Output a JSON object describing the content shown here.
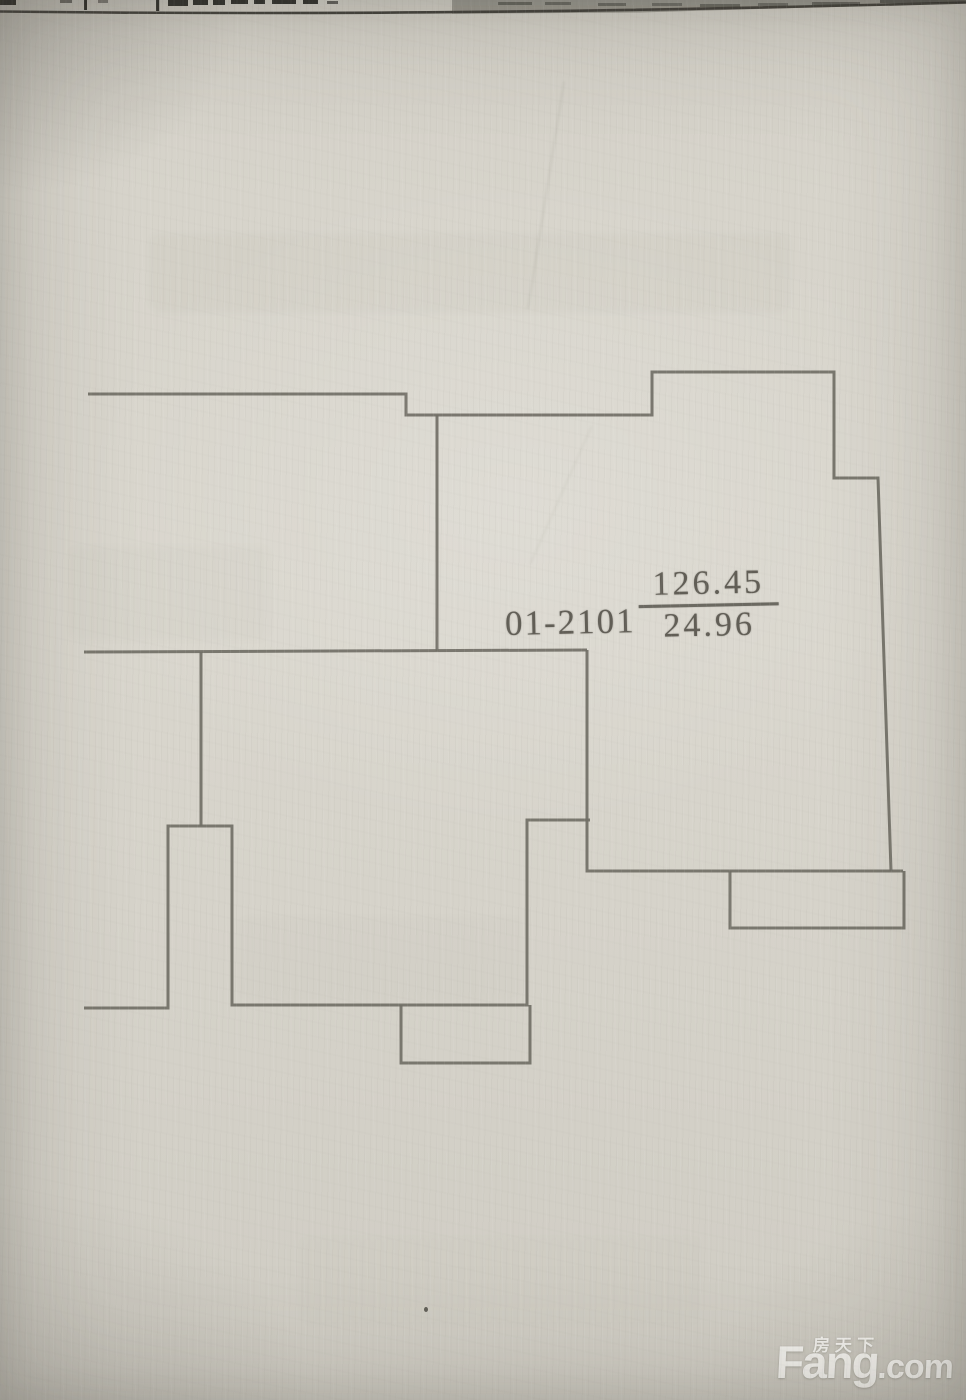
{
  "floorplan": {
    "unit_label": "01-2101",
    "area_numerator": "126.45",
    "area_denominator": "24.96",
    "stroke_color": "#716f66",
    "stroke_width": 3,
    "walls": [
      [
        [
          88,
          394
        ],
        [
          406,
          394
        ],
        [
          406,
          415
        ],
        [
          652,
          415
        ],
        [
          652,
          372
        ],
        [
          834,
          372
        ],
        [
          834,
          478
        ],
        [
          878,
          478
        ],
        [
          891,
          871
        ]
      ],
      [
        [
          587,
          650
        ],
        [
          587,
          871
        ],
        [
          903,
          871
        ]
      ],
      [
        [
          730,
          871
        ],
        [
          730,
          928
        ],
        [
          904,
          928
        ],
        [
          904,
          871
        ]
      ],
      [
        [
          84,
          652
        ],
        [
          587,
          650
        ]
      ],
      [
        [
          437,
          415
        ],
        [
          437,
          651
        ]
      ],
      [
        [
          201,
          652
        ],
        [
          201,
          826
        ]
      ],
      [
        [
          84,
          1008
        ],
        [
          168,
          1008
        ],
        [
          168,
          826
        ],
        [
          232,
          826
        ],
        [
          232,
          1005
        ],
        [
          527,
          1005
        ],
        [
          527,
          820
        ],
        [
          590,
          820
        ]
      ],
      [
        [
          401,
          1005
        ],
        [
          401,
          1063
        ],
        [
          530,
          1063
        ],
        [
          530,
          1005
        ]
      ]
    ]
  },
  "watermark": {
    "cn": "房天下",
    "brand": "Fang",
    "domain": ".com"
  }
}
